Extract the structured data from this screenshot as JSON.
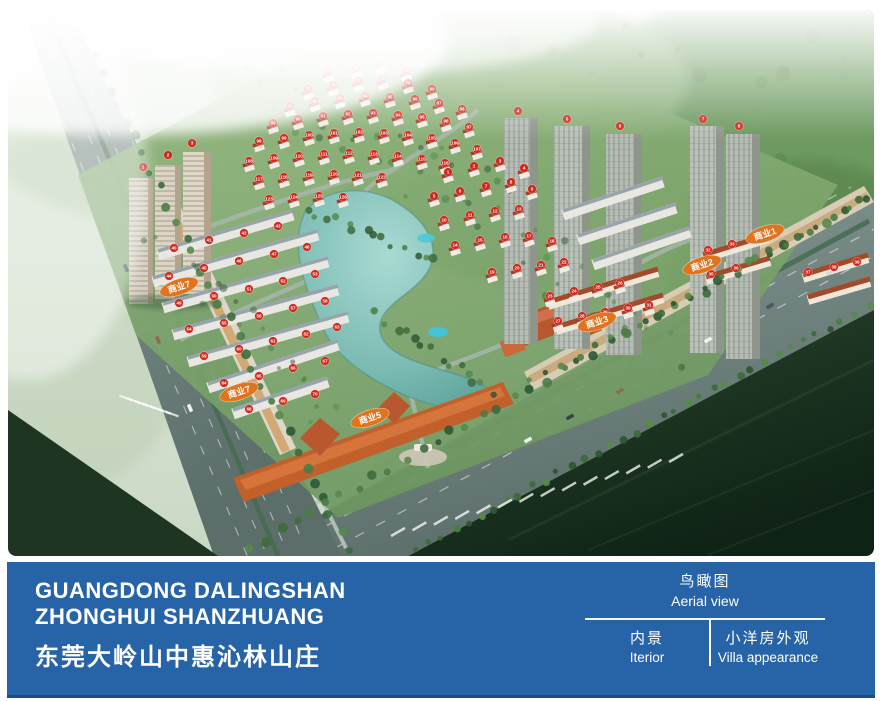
{
  "banner": {
    "bg_color": "#2763a7",
    "title_line1": "GUANGDONG DALINGSHAN",
    "title_line2": "ZHONGHUI SHANZHUANG",
    "title_cn": "东莞大岭山中惠沁林山庄",
    "view_label": {
      "cn": "鸟瞰图",
      "en": "Aerial view"
    },
    "tabs": [
      {
        "cn": "内景",
        "en": "Iterior"
      },
      {
        "cn": "小洋房外观",
        "en": "Villa appearance"
      }
    ]
  },
  "plan": {
    "marker_color": "#d1271c",
    "commercial_label_color": "#e0731d",
    "commercial_labels": [
      {
        "text": "商业1",
        "x": 765,
        "y": 234
      },
      {
        "text": "商业2",
        "x": 702,
        "y": 265
      },
      {
        "text": "商业3",
        "x": 597,
        "y": 322
      },
      {
        "text": "商业5",
        "x": 370,
        "y": 418
      },
      {
        "text": "商业7",
        "x": 179,
        "y": 287
      },
      {
        "text": "商业7",
        "x": 239,
        "y": 392
      }
    ],
    "villa_markers": [
      [
        1,
        440,
        162
      ],
      [
        2,
        466,
        156
      ],
      [
        3,
        492,
        151
      ],
      [
        4,
        516,
        158
      ],
      [
        5,
        426,
        186
      ],
      [
        6,
        452,
        181
      ],
      [
        7,
        478,
        176
      ],
      [
        8,
        503,
        172
      ],
      [
        9,
        524,
        179
      ],
      [
        10,
        436,
        210
      ],
      [
        11,
        462,
        205
      ],
      [
        12,
        487,
        201
      ],
      [
        13,
        511,
        199
      ],
      [
        14,
        447,
        235
      ],
      [
        15,
        472,
        230
      ],
      [
        16,
        497,
        227
      ],
      [
        17,
        521,
        226
      ],
      [
        18,
        544,
        231
      ],
      [
        19,
        484,
        262
      ],
      [
        20,
        509,
        258
      ],
      [
        21,
        533,
        255
      ],
      [
        22,
        556,
        252
      ],
      [
        23,
        542,
        286
      ],
      [
        24,
        566,
        281
      ],
      [
        25,
        590,
        277
      ],
      [
        26,
        612,
        273
      ],
      [
        27,
        550,
        311
      ],
      [
        28,
        574,
        306
      ],
      [
        29,
        597,
        302
      ],
      [
        30,
        620,
        298
      ],
      [
        31,
        641,
        295
      ],
      [
        71,
        320,
        62
      ],
      [
        72,
        348,
        58
      ],
      [
        73,
        372,
        53
      ],
      [
        74,
        398,
        61
      ],
      [
        75,
        300,
        79
      ],
      [
        76,
        325,
        75
      ],
      [
        77,
        350,
        71
      ],
      [
        78,
        375,
        69
      ],
      [
        79,
        400,
        73
      ],
      [
        80,
        424,
        79
      ],
      [
        81,
        282,
        96
      ],
      [
        82,
        307,
        91
      ],
      [
        83,
        332,
        88
      ],
      [
        84,
        357,
        86
      ],
      [
        85,
        382,
        87
      ],
      [
        86,
        407,
        89
      ],
      [
        87,
        431,
        93
      ],
      [
        88,
        454,
        99
      ],
      [
        89,
        265,
        113
      ],
      [
        90,
        290,
        109
      ],
      [
        91,
        315,
        106
      ],
      [
        92,
        340,
        104
      ],
      [
        93,
        365,
        103
      ],
      [
        94,
        390,
        105
      ],
      [
        95,
        414,
        107
      ],
      [
        96,
        438,
        111
      ],
      [
        97,
        461,
        117
      ],
      [
        98,
        251,
        131
      ],
      [
        99,
        276,
        128
      ],
      [
        100,
        301,
        125
      ],
      [
        101,
        326,
        123
      ],
      [
        102,
        351,
        122
      ],
      [
        103,
        376,
        123
      ],
      [
        104,
        400,
        125
      ],
      [
        105,
        424,
        128
      ],
      [
        106,
        447,
        133
      ],
      [
        107,
        469,
        139
      ],
      [
        108,
        241,
        151
      ],
      [
        109,
        266,
        148
      ],
      [
        110,
        291,
        146
      ],
      [
        111,
        316,
        144
      ],
      [
        112,
        341,
        143
      ],
      [
        113,
        366,
        144
      ],
      [
        114,
        390,
        146
      ],
      [
        115,
        414,
        149
      ],
      [
        116,
        437,
        153
      ],
      [
        117,
        251,
        169
      ],
      [
        118,
        276,
        167
      ],
      [
        119,
        301,
        165
      ],
      [
        120,
        326,
        164
      ],
      [
        121,
        350,
        165
      ],
      [
        122,
        374,
        167
      ],
      [
        123,
        261,
        189
      ],
      [
        124,
        286,
        187
      ],
      [
        125,
        311,
        186
      ],
      [
        126,
        335,
        187
      ]
    ],
    "row_markers": [
      [
        32,
        700,
        240
      ],
      [
        33,
        724,
        234
      ],
      [
        34,
        747,
        229
      ],
      [
        35,
        703,
        264
      ],
      [
        36,
        728,
        258
      ],
      [
        37,
        800,
        262
      ],
      [
        38,
        826,
        257
      ],
      [
        39,
        849,
        252
      ],
      [
        40,
        166,
        238
      ],
      [
        41,
        201,
        230
      ],
      [
        42,
        236,
        223
      ],
      [
        43,
        270,
        216
      ],
      [
        44,
        161,
        266
      ],
      [
        45,
        196,
        258
      ],
      [
        46,
        231,
        251
      ],
      [
        47,
        266,
        244
      ],
      [
        48,
        299,
        237
      ],
      [
        49,
        171,
        293
      ],
      [
        50,
        206,
        286
      ],
      [
        51,
        241,
        279
      ],
      [
        52,
        275,
        271
      ],
      [
        53,
        307,
        264
      ],
      [
        54,
        181,
        319
      ],
      [
        55,
        216,
        313
      ],
      [
        56,
        251,
        306
      ],
      [
        57,
        285,
        298
      ],
      [
        58,
        317,
        291
      ],
      [
        59,
        196,
        346
      ],
      [
        60,
        231,
        339
      ],
      [
        61,
        265,
        331
      ],
      [
        62,
        298,
        324
      ],
      [
        63,
        329,
        317
      ],
      [
        64,
        216,
        373
      ],
      [
        65,
        251,
        366
      ],
      [
        66,
        285,
        358
      ],
      [
        67,
        317,
        351
      ],
      [
        68,
        241,
        399
      ],
      [
        69,
        275,
        391
      ],
      [
        70,
        307,
        384
      ]
    ],
    "tower_markers": [
      [
        1,
        135,
        157
      ],
      [
        2,
        160,
        145
      ],
      [
        3,
        184,
        133
      ],
      [
        4,
        510,
        101
      ],
      [
        5,
        559,
        109
      ],
      [
        6,
        612,
        116
      ],
      [
        7,
        695,
        109
      ],
      [
        8,
        731,
        116
      ]
    ]
  }
}
